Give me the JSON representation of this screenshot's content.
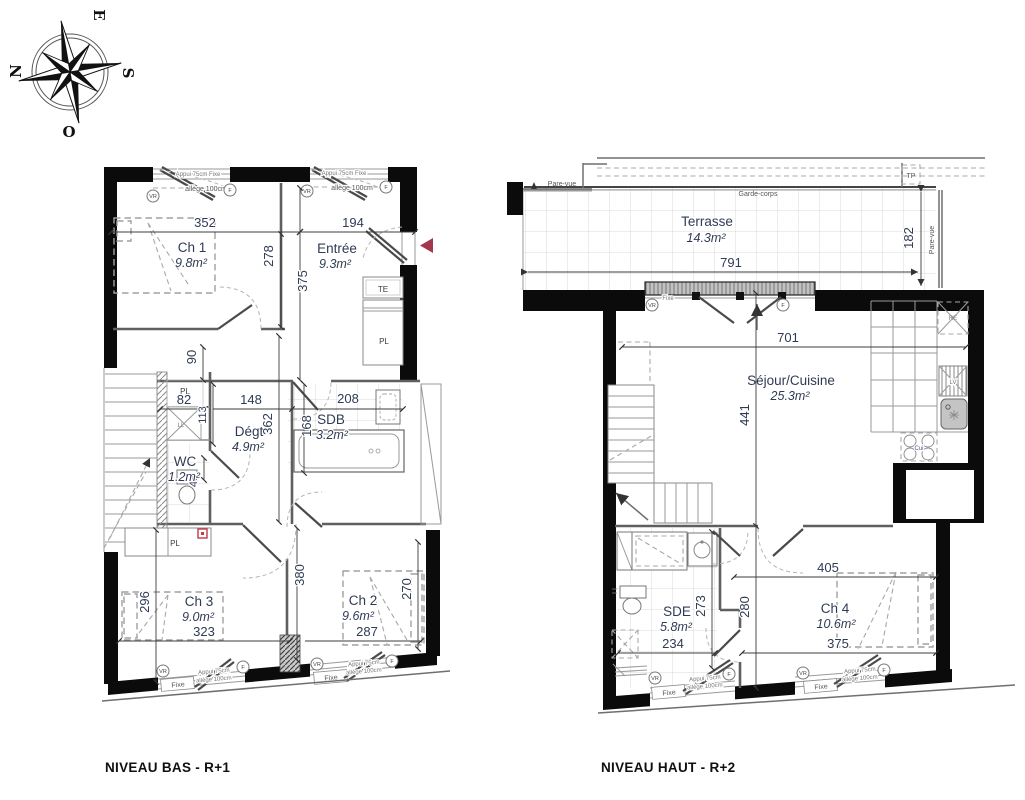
{
  "compass": {
    "e": "E",
    "n": "N",
    "s": "S",
    "o": "O"
  },
  "captions": {
    "low": "NIVEAU BAS - R+1",
    "high": "NIVEAU HAUT - R+2"
  },
  "low": {
    "rooms": {
      "ch1": {
        "name": "Ch 1",
        "area": "9.8m²"
      },
      "entree": {
        "name": "Entrée",
        "area": "9.3m²"
      },
      "degt": {
        "name": "Dégt",
        "area": "4.9m²"
      },
      "sdb": {
        "name": "SDB",
        "area": "3.2m²"
      },
      "wc": {
        "name": "WC",
        "area": "1.2m²"
      },
      "ch3": {
        "name": "Ch 3",
        "area": "9.0m²"
      },
      "ch2": {
        "name": "Ch 2",
        "area": "9.6m²"
      }
    },
    "dims": {
      "ch1_w": "352",
      "entree_w": "194",
      "ch1_h": "278",
      "entree_h": "375",
      "hall_w": "90",
      "pl_w": "82",
      "pl_h": "113",
      "degt_w": "148",
      "sdb_w": "208",
      "degt_h": "362",
      "sdb_h": "168",
      "wc_w": "45",
      "ch3_h": "296",
      "ch3_w": "323",
      "hall_h": "380",
      "ch2_h": "270",
      "ch2_w": "287"
    },
    "labels": {
      "te": "TE",
      "pl": "PL",
      "ll": "LL"
    }
  },
  "high": {
    "rooms": {
      "terrasse": {
        "name": "Terrasse",
        "area": "14.3m²"
      },
      "sejour": {
        "name": "Séjour/Cuisine",
        "area": "25.3m²"
      },
      "sde": {
        "name": "SDE",
        "area": "5.8m²"
      },
      "ch4": {
        "name": "Ch 4",
        "area": "10.6m²"
      }
    },
    "dims": {
      "terrasse_w": "791",
      "terrasse_h": "182",
      "sejour_w": "701",
      "sejour_h": "441",
      "hall_h": "280",
      "sde_h": "273",
      "sde_w": "234",
      "ch4_wtop": "405",
      "ch4_w": "375"
    },
    "labels": {
      "pare_vue": "Pare-vue",
      "garde_corps": "Garde-corps",
      "tp": "TP",
      "re": "RE",
      "lv": "LV",
      "cui": "Cui"
    }
  },
  "win": {
    "fixe": "Fixe",
    "appui_fixe": "Appui 75cm Fixe",
    "appui": "Appui 75cm",
    "allege": "allège 100cm",
    "vr": "VR",
    "f": "F"
  }
}
